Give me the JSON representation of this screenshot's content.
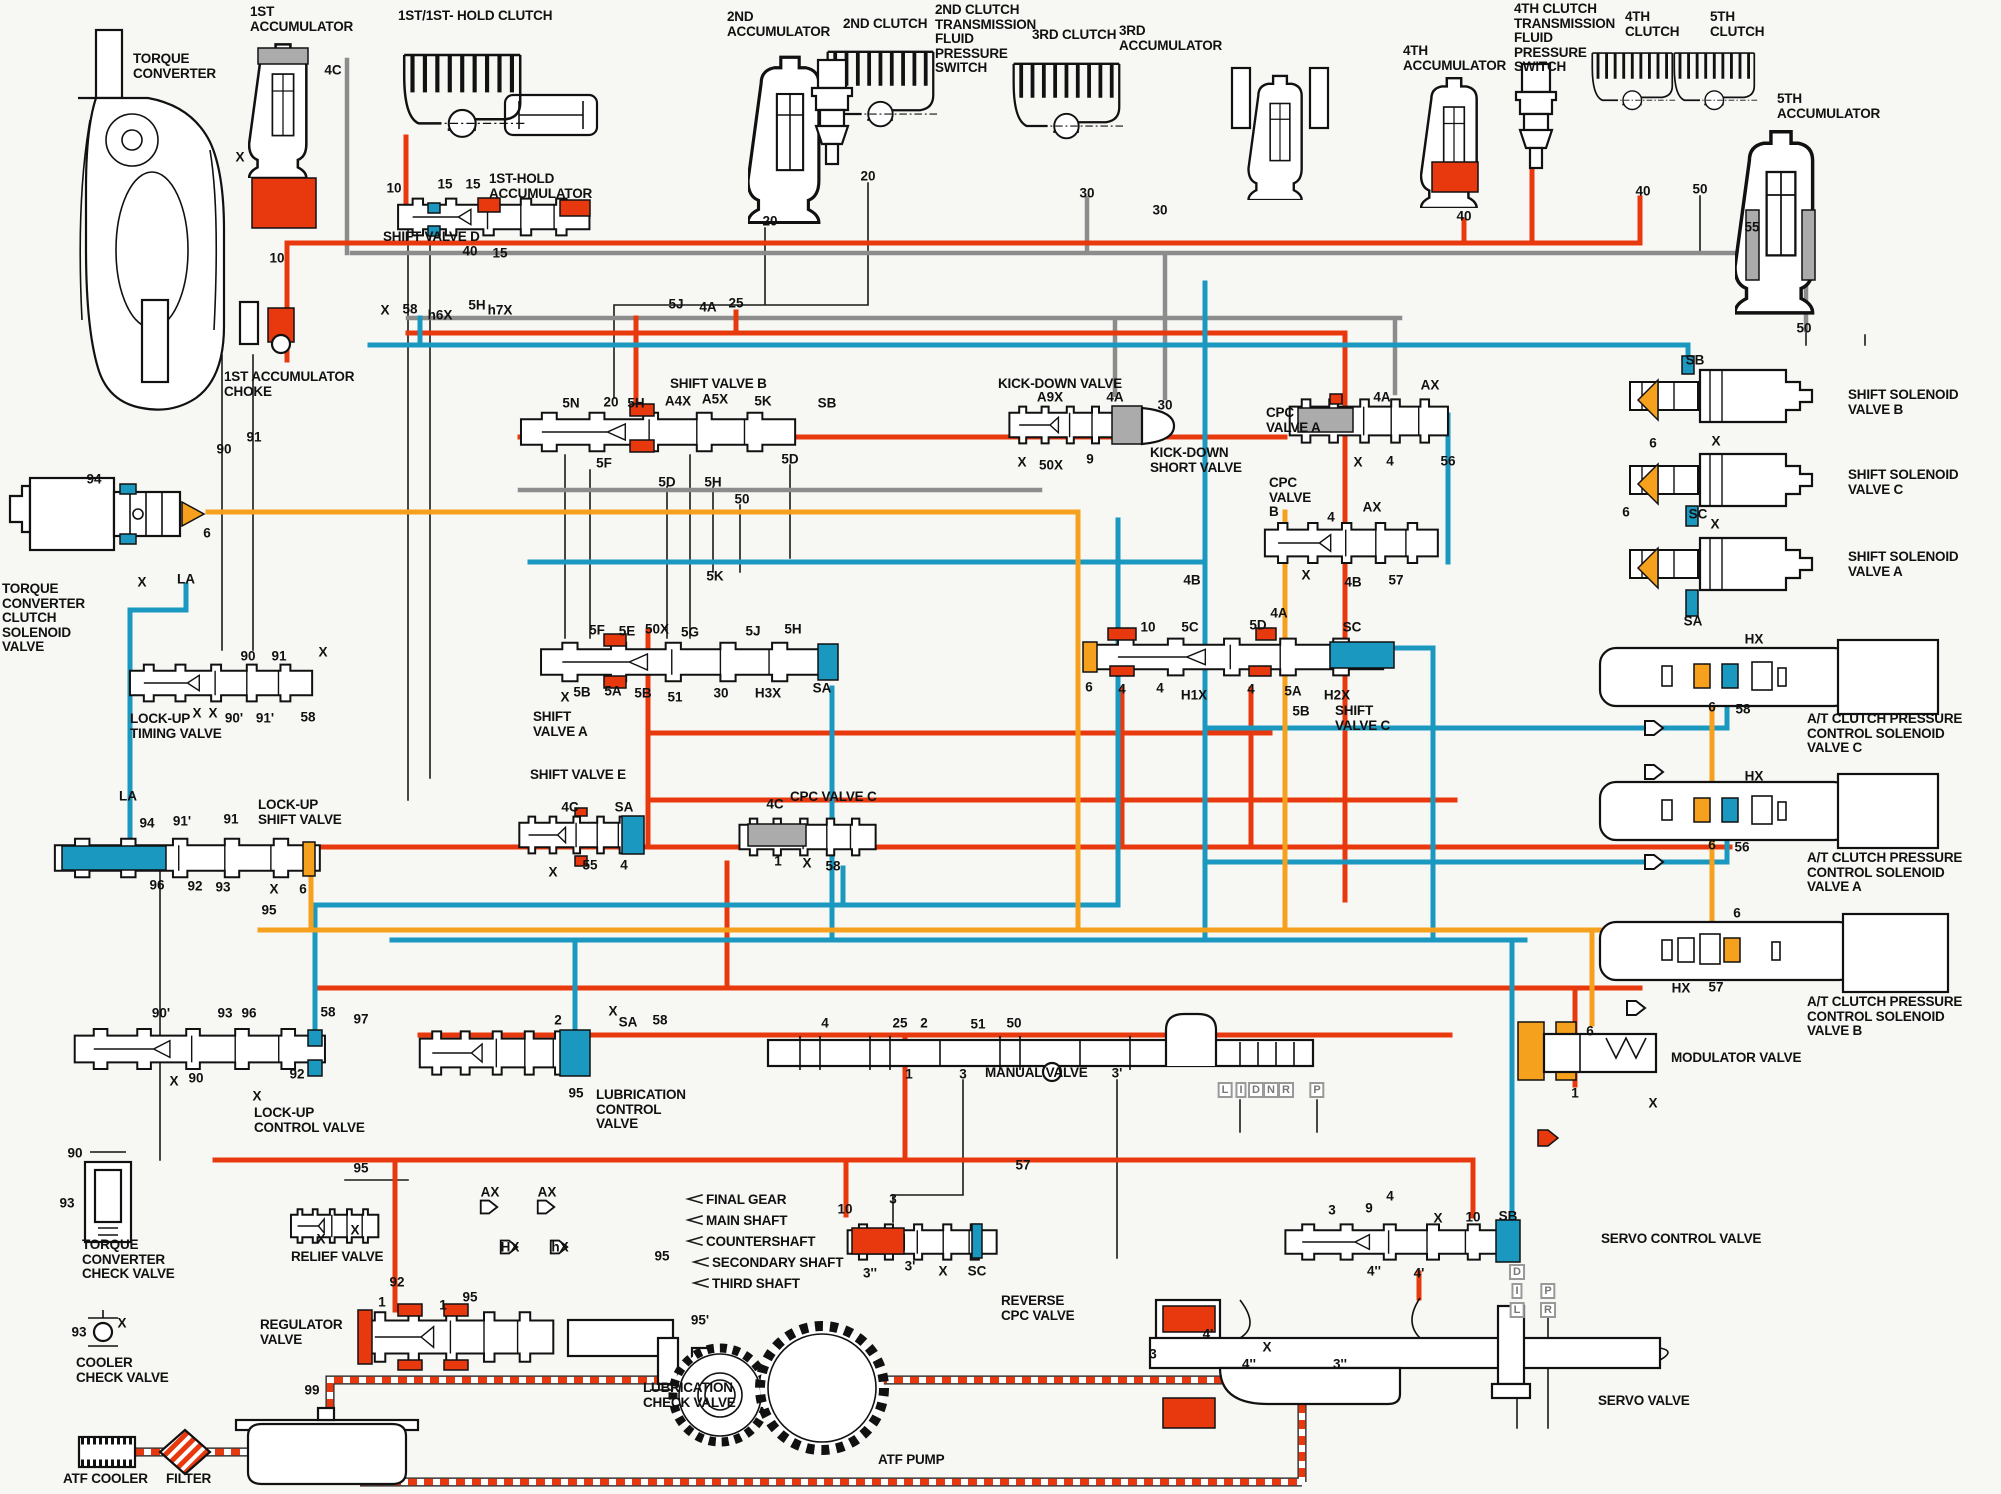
{
  "colors": {
    "red": "#e8380d",
    "blue": "#1b98c0",
    "orange": "#f6a11d",
    "gray": "#8c8c8c",
    "bg": "#f7f7f4"
  },
  "component_labels": [
    {
      "id": "torque-converter",
      "text": "TORQUE\nCONVERTER",
      "x": 133,
      "y": 52
    },
    {
      "id": "1st-accumulator",
      "text": "1ST\nACCUMULATOR",
      "x": 250,
      "y": 5
    },
    {
      "id": "1st-1st-hold-clutch",
      "text": "1ST/1ST- HOLD CLUTCH",
      "x": 398,
      "y": 9
    },
    {
      "id": "1st-hold-accumulator",
      "text": "1ST-HOLD\nACCUMULATOR",
      "x": 489,
      "y": 172
    },
    {
      "id": "2nd-accumulator",
      "text": "2ND\nACCUMULATOR",
      "x": 727,
      "y": 10
    },
    {
      "id": "2nd-clutch",
      "text": "2ND CLUTCH",
      "x": 843,
      "y": 17
    },
    {
      "id": "2nd-clutch-pressure-switch",
      "text": "2ND CLUTCH\nTRANSMISSION\nFLUID\nPRESSURE\nSWITCH",
      "x": 935,
      "y": 3
    },
    {
      "id": "3rd-clutch",
      "text": "3RD CLUTCH",
      "x": 1032,
      "y": 28
    },
    {
      "id": "3rd-accumulator",
      "text": "3RD\nACCUMULATOR",
      "x": 1119,
      "y": 24
    },
    {
      "id": "4th-accumulator",
      "text": "4TH\nACCUMULATOR",
      "x": 1403,
      "y": 44
    },
    {
      "id": "4th-clutch-pressure-switch",
      "text": "4TH CLUTCH\nTRANSMISSION\nFLUID\nPRESSURE\nSWITCH",
      "x": 1514,
      "y": 2
    },
    {
      "id": "4th-clutch",
      "text": "4TH\nCLUTCH",
      "x": 1625,
      "y": 10
    },
    {
      "id": "5th-clutch",
      "text": "5TH\nCLUTCH",
      "x": 1710,
      "y": 10
    },
    {
      "id": "5th-accumulator",
      "text": "5TH\nACCUMULATOR",
      "x": 1777,
      "y": 92
    },
    {
      "id": "shift-valve-d",
      "text": "SHIFT VALVE D",
      "x": 383,
      "y": 230
    },
    {
      "id": "1st-accumulator-choke",
      "text": "1ST ACCUMULATOR\nCHOKE",
      "x": 224,
      "y": 370
    },
    {
      "id": "shift-valve-b",
      "text": "SHIFT VALVE B",
      "x": 670,
      "y": 377
    },
    {
      "id": "kick-down-valve",
      "text": "KICK-DOWN VALVE",
      "x": 998,
      "y": 377
    },
    {
      "id": "kick-down-short-valve",
      "text": "KICK-DOWN\nSHORT VALVE",
      "x": 1150,
      "y": 446
    },
    {
      "id": "cpc-valve-a",
      "text": "CPC\nVALVE A",
      "x": 1266,
      "y": 406
    },
    {
      "id": "cpc-valve-b",
      "text": "CPC\nVALVE\nB",
      "x": 1269,
      "y": 476
    },
    {
      "id": "shift-solenoid-valve-b",
      "text": "SHIFT SOLENOID\nVALVE B",
      "x": 1848,
      "y": 388
    },
    {
      "id": "shift-solenoid-valve-c",
      "text": "SHIFT SOLENOID\nVALVE C",
      "x": 1848,
      "y": 468
    },
    {
      "id": "shift-solenoid-valve-a",
      "text": "SHIFT SOLENOID\nVALVE A",
      "x": 1848,
      "y": 550
    },
    {
      "id": "at-cpc-solenoid-valve-c",
      "text": "A/T CLUTCH PRESSURE\nCONTROL SOLENOID\nVALVE C",
      "x": 1807,
      "y": 712
    },
    {
      "id": "at-cpc-solenoid-valve-a",
      "text": "A/T CLUTCH PRESSURE\nCONTROL SOLENOID\nVALVE A",
      "x": 1807,
      "y": 851
    },
    {
      "id": "at-cpc-solenoid-valve-b",
      "text": "A/T CLUTCH PRESSURE\nCONTROL SOLENOID\nVALVE B",
      "x": 1807,
      "y": 995
    },
    {
      "id": "tc-clutch-solenoid-valve",
      "text": "TORQUE\nCONVERTER\nCLUTCH\nSOLENOID\nVALVE",
      "x": 2,
      "y": 582
    },
    {
      "id": "lock-up-timing-valve",
      "text": "LOCK-UP\nTIMING VALVE",
      "x": 130,
      "y": 712
    },
    {
      "id": "lock-up-shift-valve",
      "text": "LOCK-UP\nSHIFT VALVE",
      "x": 258,
      "y": 798
    },
    {
      "id": "lock-up-control-valve",
      "text": "LOCK-UP\nCONTROL VALVE",
      "x": 254,
      "y": 1106
    },
    {
      "id": "shift-valve-a",
      "text": "SHIFT\nVALVE A",
      "x": 533,
      "y": 710
    },
    {
      "id": "shift-valve-e",
      "text": "SHIFT VALVE E",
      "x": 530,
      "y": 768
    },
    {
      "id": "cpc-valve-c",
      "text": "CPC VALVE C",
      "x": 790,
      "y": 790
    },
    {
      "id": "shift-valve-c",
      "text": "SHIFT\nVALVE C",
      "x": 1335,
      "y": 704
    },
    {
      "id": "modulator-valve",
      "text": "MODULATOR VALVE",
      "x": 1671,
      "y": 1051
    },
    {
      "id": "servo-control-valve",
      "text": "SERVO CONTROL VALVE",
      "x": 1601,
      "y": 1232
    },
    {
      "id": "manual-valve",
      "text": "MANUAL VALVE",
      "x": 985,
      "y": 1066
    },
    {
      "id": "reverse-cpc-valve",
      "text": "REVERSE\nCPC VALVE",
      "x": 1001,
      "y": 1294
    },
    {
      "id": "servo-valve",
      "text": "SERVO VALVE",
      "x": 1598,
      "y": 1394
    },
    {
      "id": "torque-converter-check-valve",
      "text": "TORQUE\nCONVERTER\nCHECK VALVE",
      "x": 82,
      "y": 1238
    },
    {
      "id": "cooler-check-valve",
      "text": "COOLER\nCHECK VALVE",
      "x": 76,
      "y": 1356
    },
    {
      "id": "relief-valve",
      "text": "RELIEF VALVE",
      "x": 291,
      "y": 1250
    },
    {
      "id": "regulator-valve",
      "text": "REGULATOR\nVALVE",
      "x": 260,
      "y": 1318
    },
    {
      "id": "lubrication-control-valve",
      "text": "LUBRICATION\nCONTROL\nVALVE",
      "x": 596,
      "y": 1088
    },
    {
      "id": "lubrication-check-valve",
      "text": "LUBRICATION\nCHECK VALVE",
      "x": 643,
      "y": 1381
    },
    {
      "id": "atf-pump",
      "text": "ATF PUMP",
      "x": 878,
      "y": 1453
    },
    {
      "id": "atf-cooler",
      "text": "ATF COOLER",
      "x": 63,
      "y": 1472
    },
    {
      "id": "filter",
      "text": "FILTER",
      "x": 166,
      "y": 1472
    },
    {
      "id": "final-gear",
      "text": "FINAL GEAR",
      "x": 706,
      "y": 1193
    },
    {
      "id": "main-shaft",
      "text": "MAIN SHAFT",
      "x": 706,
      "y": 1214
    },
    {
      "id": "countershaft",
      "text": "COUNTERSHAFT",
      "x": 706,
      "y": 1235
    },
    {
      "id": "secondary-shaft",
      "text": "SECONDARY SHAFT",
      "x": 712,
      "y": 1256
    },
    {
      "id": "third-shaft",
      "text": "THIRD SHAFT",
      "x": 712,
      "y": 1277
    }
  ],
  "port_labels": [
    [
      "4C",
      333,
      70
    ],
    [
      "X",
      240,
      157
    ],
    [
      "10",
      277,
      258
    ],
    [
      "10",
      394,
      188
    ],
    [
      "15",
      445,
      184
    ],
    [
      "15",
      473,
      184
    ],
    [
      "40",
      470,
      251
    ],
    [
      "15",
      500,
      253
    ],
    [
      "X",
      385,
      310
    ],
    [
      "58",
      410,
      309
    ],
    [
      "h6X",
      440,
      315
    ],
    [
      "5H",
      477,
      305
    ],
    [
      "h7X",
      500,
      310
    ],
    [
      "5J",
      676,
      304
    ],
    [
      "4A",
      708,
      307
    ],
    [
      "25",
      736,
      303
    ],
    [
      "20",
      770,
      221
    ],
    [
      "20",
      868,
      176
    ],
    [
      "30",
      1087,
      193
    ],
    [
      "30",
      1160,
      210
    ],
    [
      "40",
      1464,
      216
    ],
    [
      "40",
      1643,
      191
    ],
    [
      "50",
      1700,
      189
    ],
    [
      "55",
      1752,
      227
    ],
    [
      "50",
      1804,
      328
    ],
    [
      "90",
      224,
      449
    ],
    [
      "91",
      254,
      437
    ],
    [
      "94",
      94,
      479
    ],
    [
      "6",
      207,
      533
    ],
    [
      "X",
      142,
      582
    ],
    [
      "LA",
      186,
      579
    ],
    [
      "90",
      248,
      656
    ],
    [
      "91",
      279,
      656
    ],
    [
      "X",
      323,
      652
    ],
    [
      "X",
      197,
      713
    ],
    [
      "X",
      213,
      713
    ],
    [
      "90'",
      234,
      718
    ],
    [
      "91'",
      265,
      718
    ],
    [
      "58",
      308,
      717
    ],
    [
      "5N",
      571,
      403
    ],
    [
      "20",
      611,
      402
    ],
    [
      "5H",
      636,
      403
    ],
    [
      "A4X",
      678,
      401
    ],
    [
      "A5X",
      715,
      399
    ],
    [
      "5K",
      763,
      401
    ],
    [
      "SB",
      827,
      403
    ],
    [
      "5F",
      604,
      463
    ],
    [
      "5D",
      790,
      459
    ],
    [
      "5D",
      667,
      482
    ],
    [
      "5H",
      713,
      482
    ],
    [
      "50",
      742,
      499
    ],
    [
      "5K",
      715,
      576
    ],
    [
      "A9X",
      1050,
      397
    ],
    [
      "4A",
      1115,
      397
    ],
    [
      "30",
      1165,
      405
    ],
    [
      "X",
      1022,
      462
    ],
    [
      "50X",
      1051,
      465
    ],
    [
      "9",
      1090,
      459
    ],
    [
      "4A",
      1382,
      397
    ],
    [
      "AX",
      1430,
      385
    ],
    [
      "X",
      1358,
      462
    ],
    [
      "4",
      1390,
      461
    ],
    [
      "56",
      1448,
      461
    ],
    [
      "4",
      1331,
      517
    ],
    [
      "AX",
      1372,
      507
    ],
    [
      "X",
      1306,
      575
    ],
    [
      "4B",
      1353,
      582
    ],
    [
      "57",
      1396,
      580
    ],
    [
      "4B",
      1192,
      580
    ],
    [
      "SB",
      1695,
      360
    ],
    [
      "X",
      1716,
      441
    ],
    [
      "6",
      1653,
      443
    ],
    [
      "6",
      1626,
      512
    ],
    [
      "SC",
      1698,
      514
    ],
    [
      "X",
      1715,
      524
    ],
    [
      "SA",
      1693,
      621
    ],
    [
      "HX",
      1754,
      639
    ],
    [
      "6",
      1712,
      707
    ],
    [
      "58",
      1743,
      709
    ],
    [
      "HX",
      1754,
      776
    ],
    [
      "6",
      1712,
      845
    ],
    [
      "56",
      1742,
      847
    ],
    [
      "6",
      1737,
      913
    ],
    [
      "HX",
      1681,
      988
    ],
    [
      "57",
      1716,
      987
    ],
    [
      "5F",
      597,
      630
    ],
    [
      "5E",
      627,
      631
    ],
    [
      "50X",
      657,
      629
    ],
    [
      "5G",
      690,
      632
    ],
    [
      "5J",
      753,
      631
    ],
    [
      "5H",
      793,
      629
    ],
    [
      "X",
      565,
      697
    ],
    [
      "5B",
      582,
      692
    ],
    [
      "5A",
      613,
      691
    ],
    [
      "5B",
      643,
      693
    ],
    [
      "51",
      675,
      697
    ],
    [
      "30",
      721,
      693
    ],
    [
      "H3X",
      768,
      693
    ],
    [
      "SA",
      822,
      688
    ],
    [
      "4C",
      570,
      807
    ],
    [
      "SA",
      624,
      807
    ],
    [
      "X",
      553,
      872
    ],
    [
      "55",
      590,
      865
    ],
    [
      "4",
      624,
      865
    ],
    [
      "4C",
      775,
      804
    ],
    [
      "1",
      778,
      861
    ],
    [
      "X",
      807,
      863
    ],
    [
      "58",
      833,
      866
    ],
    [
      "10",
      1148,
      627
    ],
    [
      "5C",
      1190,
      627
    ],
    [
      "5D",
      1258,
      625
    ],
    [
      "4A",
      1279,
      613
    ],
    [
      "SC",
      1352,
      627
    ],
    [
      "6",
      1089,
      687
    ],
    [
      "4",
      1122,
      689
    ],
    [
      "4",
      1160,
      688
    ],
    [
      "H1X",
      1194,
      695
    ],
    [
      "4",
      1251,
      689
    ],
    [
      "5A",
      1293,
      691
    ],
    [
      "5B",
      1301,
      711
    ],
    [
      "H2X",
      1337,
      695
    ],
    [
      "6",
      1590,
      1031
    ],
    [
      "1",
      1575,
      1093
    ],
    [
      "X",
      1653,
      1103
    ],
    [
      "3",
      1332,
      1210
    ],
    [
      "9",
      1369,
      1208
    ],
    [
      "4",
      1390,
      1196
    ],
    [
      "X",
      1438,
      1218
    ],
    [
      "10",
      1473,
      1217
    ],
    [
      "SB",
      1508,
      1216
    ],
    [
      "4''",
      1374,
      1271
    ],
    [
      "4'",
      1419,
      1273
    ],
    [
      "4",
      825,
      1023
    ],
    [
      "25",
      900,
      1023
    ],
    [
      "2",
      924,
      1023
    ],
    [
      "51",
      978,
      1024
    ],
    [
      "50",
      1014,
      1023
    ],
    [
      "1",
      909,
      1074
    ],
    [
      "3",
      963,
      1074
    ],
    [
      "3'",
      1117,
      1073
    ],
    [
      "57",
      1023,
      1165
    ],
    [
      "2",
      558,
      1020
    ],
    [
      "X",
      613,
      1011
    ],
    [
      "SA",
      628,
      1022
    ],
    [
      "58",
      660,
      1020
    ],
    [
      "95",
      576,
      1093
    ],
    [
      "AX",
      490,
      1192
    ],
    [
      "AX",
      547,
      1192
    ],
    [
      "HX",
      510,
      1247
    ],
    [
      "hX",
      560,
      1247
    ],
    [
      "95",
      662,
      1256
    ],
    [
      "95'",
      700,
      1320
    ],
    [
      "92",
      397,
      1282
    ],
    [
      "1",
      382,
      1302
    ],
    [
      "1",
      443,
      1305
    ],
    [
      "95",
      470,
      1297
    ],
    [
      "99",
      312,
      1390
    ],
    [
      "95",
      361,
      1168
    ],
    [
      "X",
      321,
      1239
    ],
    [
      "X",
      355,
      1230
    ],
    [
      "90",
      75,
      1153
    ],
    [
      "93",
      67,
      1203
    ],
    [
      "93",
      79,
      1332
    ],
    [
      "X",
      122,
      1323
    ],
    [
      "10",
      845,
      1209
    ],
    [
      "3",
      893,
      1199
    ],
    [
      "3''",
      870,
      1273
    ],
    [
      "3'",
      910,
      1266
    ],
    [
      "X",
      943,
      1271
    ],
    [
      "SC",
      977,
      1271
    ],
    [
      "3",
      1153,
      1354
    ],
    [
      "4'",
      1208,
      1334
    ],
    [
      "X",
      1267,
      1347
    ],
    [
      "4''",
      1249,
      1364
    ],
    [
      "3''",
      1340,
      1364
    ],
    [
      "LA",
      128,
      796
    ],
    [
      "94",
      147,
      823
    ],
    [
      "91'",
      182,
      821
    ],
    [
      "91",
      231,
      819
    ],
    [
      "96",
      157,
      885
    ],
    [
      "92",
      195,
      886
    ],
    [
      "93",
      223,
      887
    ],
    [
      "X",
      274,
      889
    ],
    [
      "6",
      303,
      889
    ],
    [
      "95",
      269,
      910
    ],
    [
      "90'",
      161,
      1013
    ],
    [
      "93",
      225,
      1013
    ],
    [
      "96",
      249,
      1013
    ],
    [
      "58",
      328,
      1012
    ],
    [
      "97",
      361,
      1019
    ],
    [
      "X",
      174,
      1081
    ],
    [
      "90",
      196,
      1078
    ],
    [
      "92",
      297,
      1074
    ],
    [
      "X",
      257,
      1096
    ]
  ],
  "range_boxes": [
    [
      "L",
      1225,
      1090
    ],
    [
      "I",
      1241,
      1090
    ],
    [
      "D",
      1256,
      1090
    ],
    [
      "N",
      1271,
      1090
    ],
    [
      "R",
      1286,
      1090
    ],
    [
      "P",
      1317,
      1090
    ],
    [
      "D",
      1517,
      1272
    ],
    [
      "I",
      1517,
      1291
    ],
    [
      "L",
      1517,
      1310
    ],
    [
      "P",
      1548,
      1291
    ],
    [
      "R",
      1548,
      1310
    ]
  ]
}
